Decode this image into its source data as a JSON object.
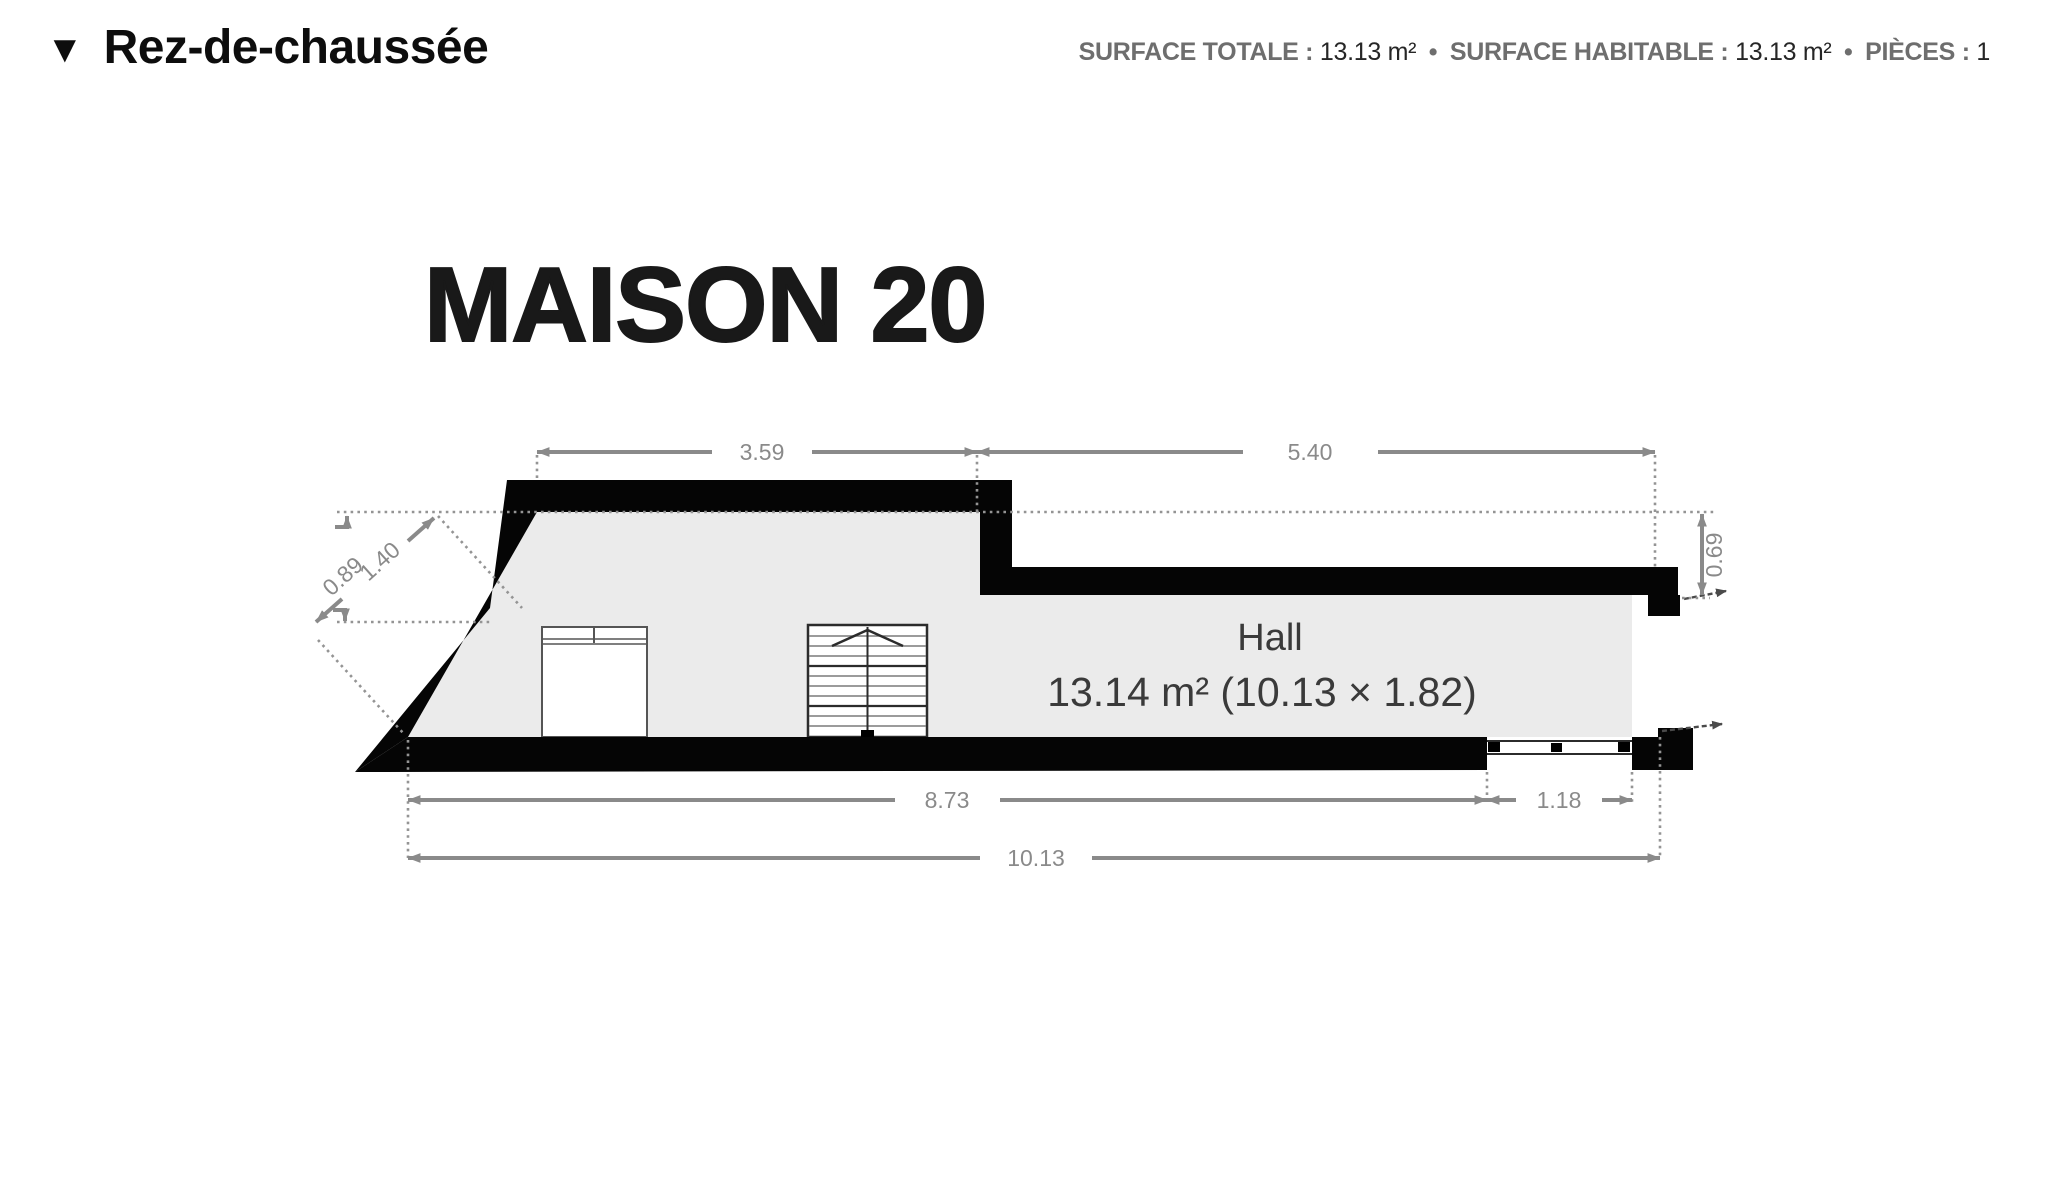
{
  "header": {
    "triangle_icon": "▼",
    "floor_label": "Rez-de-chaussée",
    "separator": "•",
    "stats": [
      {
        "label": "SURFACE TOTALE :",
        "value": "13.13 m²"
      },
      {
        "label": "SURFACE HABITABLE :",
        "value": "13.13 m²"
      },
      {
        "label": "PIÈCES :",
        "value": "1"
      }
    ]
  },
  "plan": {
    "title": "MAISON 20",
    "room": {
      "name": "Hall",
      "area_line": "13.14 m² (10.13 × 1.82)"
    },
    "dimensions": {
      "top_left": "3.59",
      "top_right": "5.40",
      "diag_outer": "0.89",
      "diag_inner": "1.40",
      "right_offset": "0.69",
      "bottom_main": "8.73",
      "bottom_window": "1.18",
      "bottom_total": "10.13"
    },
    "colors": {
      "wall": "#050505",
      "floor": "#ebebeb",
      "dimension": "#8a8a8a",
      "room_text": "#3a3a3a"
    }
  }
}
